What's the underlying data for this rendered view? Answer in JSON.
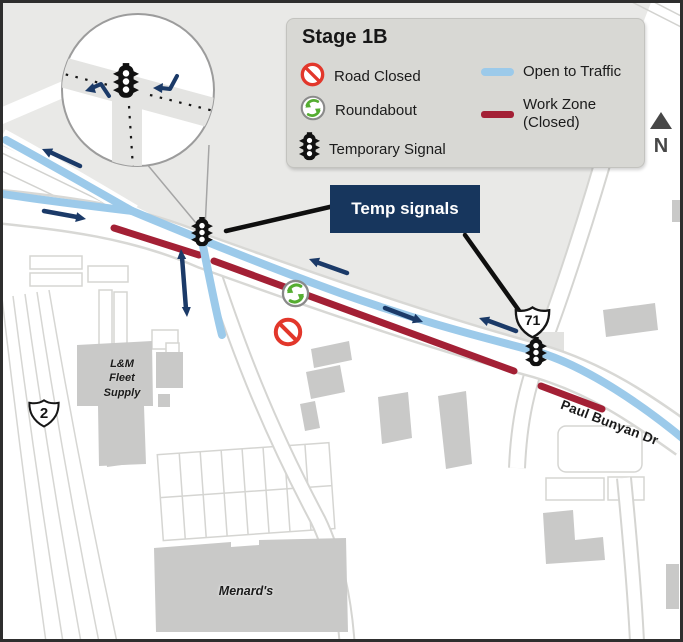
{
  "legend": {
    "title": "Stage 1B",
    "items": [
      {
        "icon": "road-closed-icon",
        "label": "Road Closed"
      },
      {
        "icon": "roundabout-icon",
        "label": "Roundabout"
      },
      {
        "icon": "temporary-signal-icon",
        "label": "Temporary Signal"
      },
      {
        "icon": "open-to-traffic-line",
        "label": "Open to Traffic"
      },
      {
        "icon": "work-zone-line",
        "label": "Work Zone (Closed)"
      }
    ]
  },
  "callout": {
    "label": "Temp signals"
  },
  "compass": {
    "label": "N"
  },
  "map": {
    "route_shields": [
      {
        "system": "US",
        "number": "2"
      },
      {
        "system": "US",
        "number": "71"
      }
    ],
    "road_labels": [
      {
        "name": "Paul Bunyan Dr"
      }
    ],
    "places": [
      {
        "name": "L&M\nFleet\nSupply"
      },
      {
        "name": "Menard's"
      }
    ]
  },
  "colors": {
    "open_to_traffic": "#9CCAEA",
    "work_zone_closed": "#A32035",
    "direction_arrow": "#1B3A68",
    "callout_background": "#17365D",
    "roundabout_green": "#55AD31",
    "road_closed_red": "#E2372B",
    "legend_background": "#D8D8D4",
    "terrain": "#E9E9E7",
    "building": "#C9C9C8"
  }
}
